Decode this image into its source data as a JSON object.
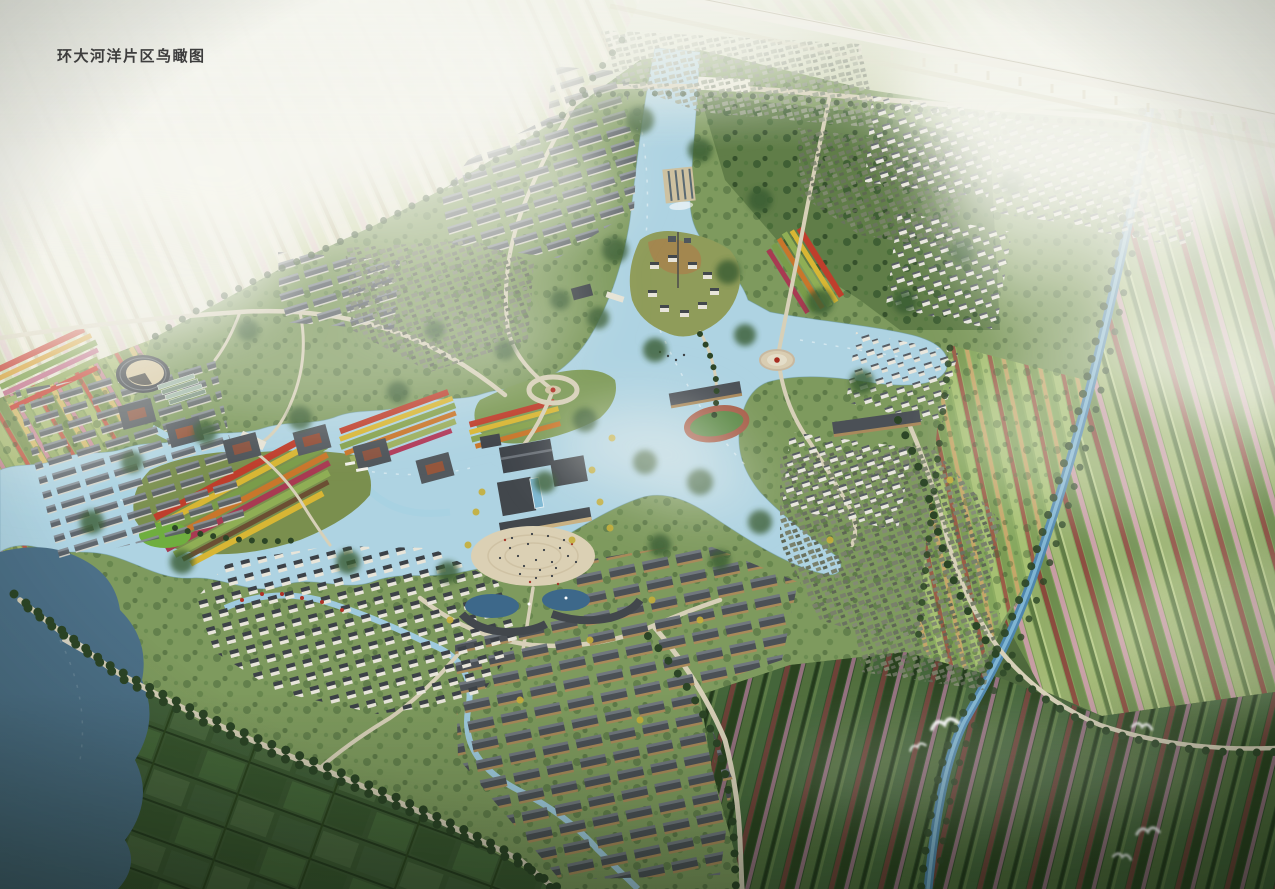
{
  "title": {
    "text": "环大河洋片区鸟瞰图"
  },
  "scene": {
    "colors": {
      "haze": "#f0f2ea",
      "water": "#aed3e2",
      "wetland": "#4c7088",
      "canal": "#4e86ad",
      "park_green": "#7e9a5e",
      "plaza": "#dbd0b4",
      "road": "#d7d0b8",
      "roof_dark": "#42474d",
      "flower_red": "#bf3e2c",
      "flower_yellow": "#d8b634",
      "tree_dark": "#2c4526",
      "viaduct": "#f2f1ea"
    }
  }
}
